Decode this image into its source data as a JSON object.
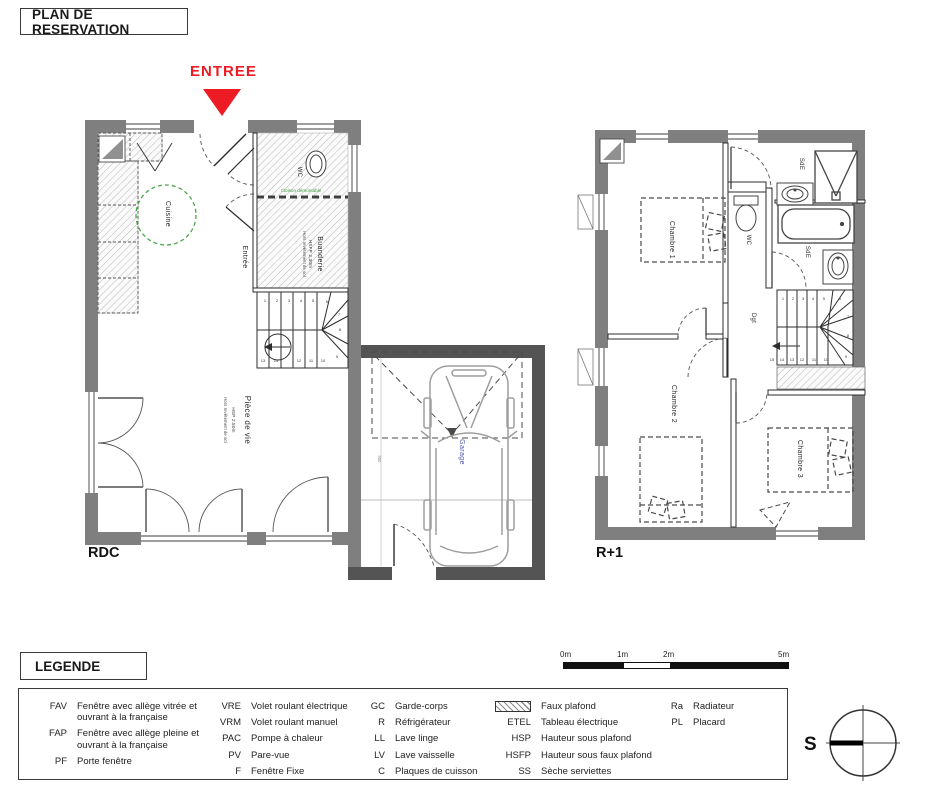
{
  "title": "PLAN DE RESERVATION",
  "entrance": {
    "label": "ENTREE"
  },
  "plans": {
    "rdc": {
      "floor_label": "RDC",
      "rooms": {
        "cuisine": "Cuisine",
        "entree": "Entrée",
        "wc": "WC",
        "buanderie": "Buanderie",
        "piece_de_vie": "Pièce de vie",
        "garage": "Garage"
      },
      "notes": {
        "piece_hsp": "HSP 2.50m",
        "piece_note": "Hors revêtement de sol",
        "buanderie_hsfp": "HSFP 2.30m",
        "buanderie_note": "Hors revêtement de sol",
        "cloison": "Cloison démontable",
        "garage_dim": "500"
      },
      "stair_numbers": [
        "1",
        "2",
        "3",
        "4",
        "5",
        "6",
        "7",
        "8",
        "9",
        "10",
        "11",
        "12",
        "13",
        "14"
      ]
    },
    "r1": {
      "floor_label": "R+1",
      "rooms": {
        "chambre1": "Chambre 1",
        "wc": "WC",
        "sde_top": "SdE",
        "sde_bottom": "SdE",
        "dgt": "Dgt",
        "chambre2": "Chambre 2",
        "chambre3": "Chambre 3"
      },
      "stair_numbers": [
        "1",
        "2",
        "3",
        "4",
        "5",
        "6",
        "7",
        "8",
        "9",
        "10",
        "11",
        "12",
        "13",
        "14",
        "15"
      ]
    }
  },
  "legend": {
    "title": "LEGENDE",
    "col1": [
      {
        "abbr": "FAV",
        "desc": "Fenêtre avec allège vitrée et ouvrant à la française"
      },
      {
        "abbr": "FAP",
        "desc": "Fenêtre avec allège pleine et ouvrant à la française"
      },
      {
        "abbr": "PF",
        "desc": "Porte fenêtre"
      }
    ],
    "col2": [
      {
        "abbr": "VRE",
        "desc": "Volet roulant électrique"
      },
      {
        "abbr": "VRM",
        "desc": "Volet roulant manuel"
      },
      {
        "abbr": "PAC",
        "desc": "Pompe à chaleur"
      },
      {
        "abbr": "PV",
        "desc": "Pare-vue"
      },
      {
        "abbr": "F",
        "desc": "Fenêtre Fixe"
      }
    ],
    "col3": [
      {
        "abbr": "GC",
        "desc": "Garde-corps"
      },
      {
        "abbr": "R",
        "desc": "Réfrigérateur"
      },
      {
        "abbr": "LL",
        "desc": "Lave linge"
      },
      {
        "abbr": "LV",
        "desc": "Lave vaisselle"
      },
      {
        "abbr": "C",
        "desc": "Plaques de cuisson"
      }
    ],
    "col4": [
      {
        "abbr": "",
        "desc": "Faux plafond"
      },
      {
        "abbr": "ETEL",
        "desc": "Tableau électrique"
      },
      {
        "abbr": "HSP",
        "desc": "Hauteur sous plafond"
      },
      {
        "abbr": "HSFP",
        "desc": "Hauteur sous faux plafond"
      },
      {
        "abbr": "SS",
        "desc": "Sèche serviettes"
      }
    ],
    "col5": [
      {
        "abbr": "Ra",
        "desc": "Radiateur"
      },
      {
        "abbr": "PL",
        "desc": "Placard"
      }
    ]
  },
  "scale_bar": {
    "labels": [
      "0m",
      "1m",
      "2m",
      "5m"
    ]
  },
  "compass": {
    "label": "S"
  },
  "colors": {
    "wall": "#7f7f7f",
    "garage_wall": "#545454",
    "accent_red": "#ed1c24",
    "green": "#3f9a3f",
    "blue": "#4353a8"
  }
}
